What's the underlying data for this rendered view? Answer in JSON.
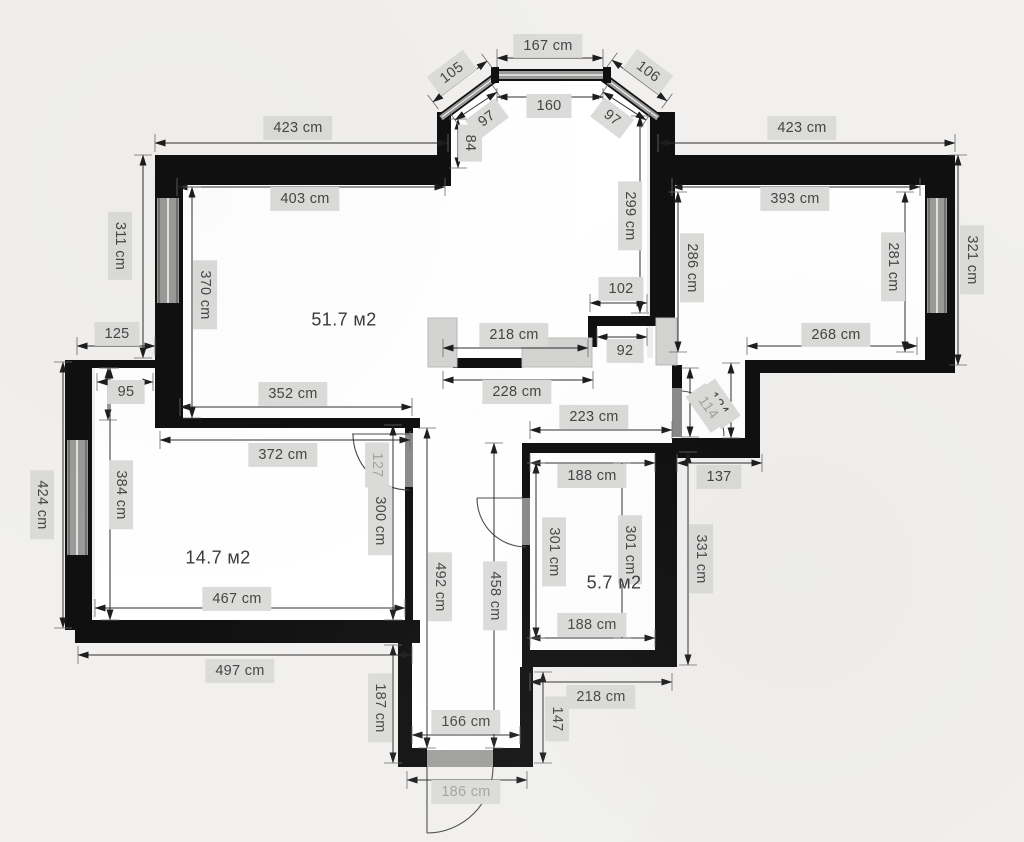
{
  "meta": {
    "type": "architectural-floor-plan",
    "unit": "cm",
    "area_unit": "м2"
  },
  "rooms": [
    {
      "name": "living-room-kitchen",
      "area_label": "51.7 м2"
    },
    {
      "name": "bedroom",
      "area_label": "14.7 м2"
    },
    {
      "name": "storage-room",
      "area_label": "5.7 м2"
    }
  ],
  "colors": {
    "background": "#f1f0ee",
    "wall": "#101010",
    "room_fill": "#ffffff",
    "label_bg": "#dbdbd9",
    "dim_line": "#2e2e2e",
    "text": "#454545",
    "light_text": "#a2a2a0",
    "window": "#8f8f8d",
    "furniture": "#d4d4d2",
    "door": "#8a8a88"
  },
  "labels": [
    {
      "text": "167 cm"
    },
    {
      "text": "105"
    },
    {
      "text": "106"
    },
    {
      "text": "160"
    },
    {
      "text": "97"
    },
    {
      "text": "97"
    },
    {
      "text": "84"
    },
    {
      "text": "423 cm"
    },
    {
      "text": "423 cm"
    },
    {
      "text": "403 cm"
    },
    {
      "text": "393 cm"
    },
    {
      "text": "311 cm"
    },
    {
      "text": "370 cm"
    },
    {
      "text": "51.7 м2"
    },
    {
      "text": "299 cm"
    },
    {
      "text": "286 cm"
    },
    {
      "text": "321 cm"
    },
    {
      "text": "281 cm"
    },
    {
      "text": "268 cm"
    },
    {
      "text": "102"
    },
    {
      "text": "218 cm"
    },
    {
      "text": "92"
    },
    {
      "text": "228 cm"
    },
    {
      "text": "223 cm"
    },
    {
      "text": "124"
    },
    {
      "text": "114"
    },
    {
      "text": "137"
    },
    {
      "text": "125"
    },
    {
      "text": "95"
    },
    {
      "text": "352 cm"
    },
    {
      "text": "372 cm"
    },
    {
      "text": "424 cm"
    },
    {
      "text": "384 cm"
    },
    {
      "text": "14.7 м2"
    },
    {
      "text": "127"
    },
    {
      "text": "300 cm"
    },
    {
      "text": "467 cm"
    },
    {
      "text": "497 cm"
    },
    {
      "text": "492 cm"
    },
    {
      "text": "458 cm"
    },
    {
      "text": "188 cm"
    },
    {
      "text": "301 cm"
    },
    {
      "text": "301 cm"
    },
    {
      "text": "5.7 м2"
    },
    {
      "text": "188 cm"
    },
    {
      "text": "331 cm"
    },
    {
      "text": "187 cm"
    },
    {
      "text": "166 cm"
    },
    {
      "text": "147"
    },
    {
      "text": "218 cm"
    },
    {
      "text": "186 cm"
    }
  ]
}
